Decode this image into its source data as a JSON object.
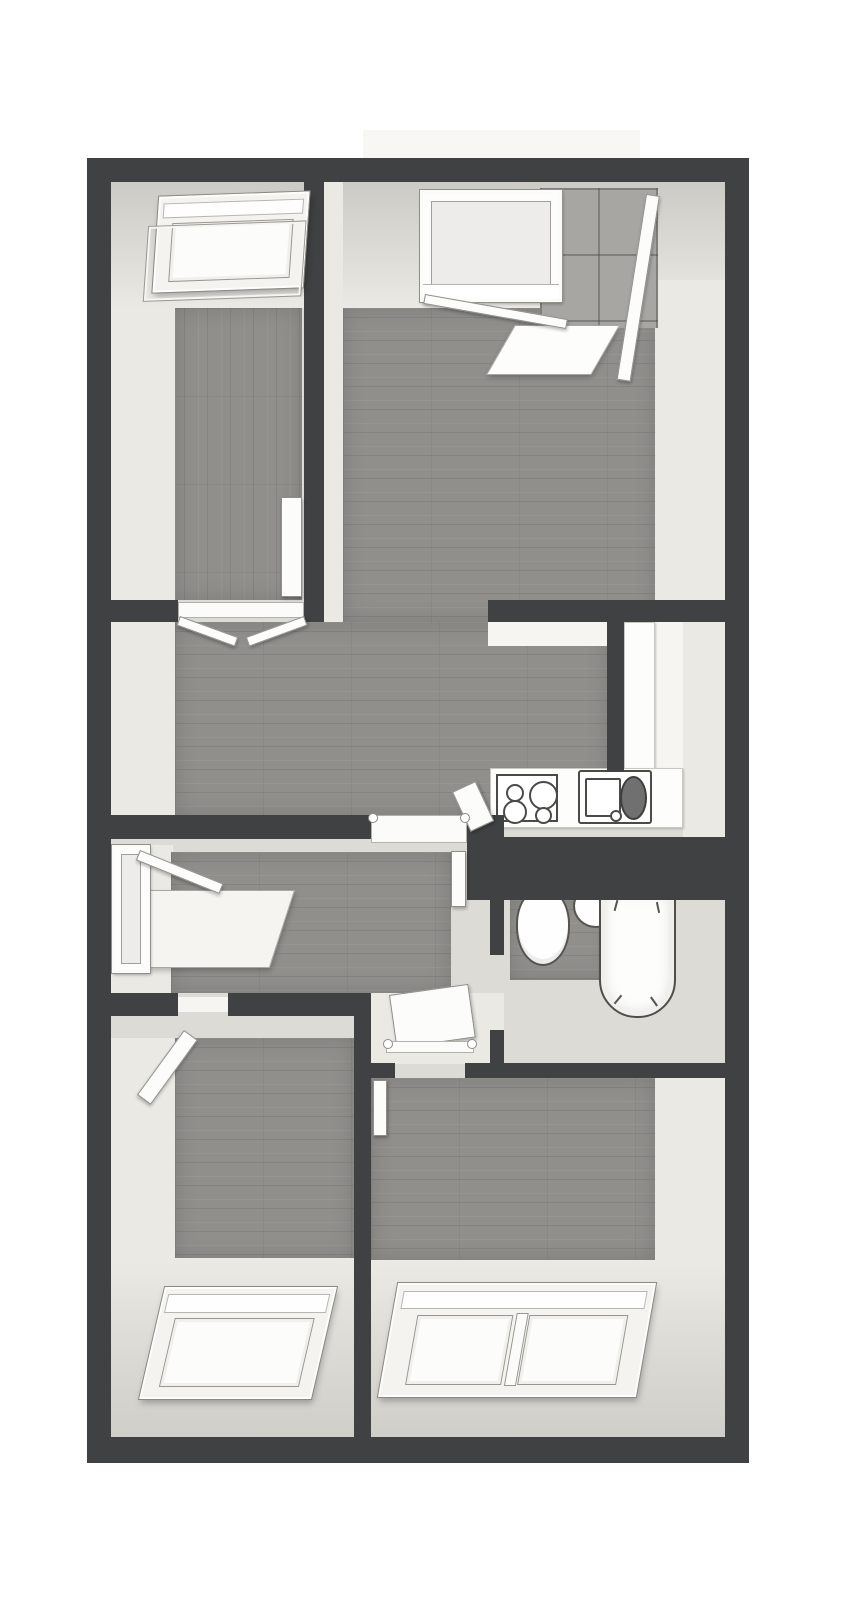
{
  "meta": {
    "kind": "floor-plan-3d-render",
    "canvas": {
      "width": 867,
      "height": 1600
    }
  },
  "palette": {
    "paper": "#ffffff",
    "wall_dark": "#3f4142",
    "face_light": "#eae9e4",
    "face_mid": "#dcdbd6",
    "face_dim": "#cfcec9",
    "wood": "#908f8c",
    "white": "#fdfdfc",
    "off_white": "#f6f5f2",
    "balcony_slab": "#f8f7f4",
    "tile_gray": "#a7a6a3",
    "fixture_outline": "#4a4a48",
    "drainer_dark": "#707070"
  },
  "rooms": [
    {
      "name": "bedroom-top-left",
      "features": [
        "roof-window"
      ]
    },
    {
      "name": "living-room",
      "features": [
        "window",
        "balcony-door",
        "tiled-balcony"
      ]
    },
    {
      "name": "kitchen-nook",
      "features": [
        "l-counter",
        "cooktop-4-burners",
        "sink-with-drainer"
      ]
    },
    {
      "name": "hallway-upper",
      "features": [
        "double-door-to-bedroom"
      ]
    },
    {
      "name": "hallway-lower",
      "features": [
        "side-window",
        "window-bench"
      ]
    },
    {
      "name": "bathroom",
      "features": [
        "toilet",
        "washbasin",
        "bathtub"
      ]
    },
    {
      "name": "bedroom-bottom-left",
      "features": [
        "roof-window",
        "door"
      ]
    },
    {
      "name": "bedroom-bottom-right",
      "features": [
        "double-roof-window",
        "door"
      ]
    }
  ],
  "elements": [
    {
      "name": "balcony-slab",
      "type": "rect",
      "x": 363,
      "y": 130,
      "w": 277,
      "h": 28,
      "z": 0,
      "fill": "balcony_slab"
    },
    {
      "name": "plan-base",
      "type": "rect",
      "x": 87,
      "y": 158,
      "w": 662,
      "h": 1305,
      "z": 0,
      "fill": "face_mid"
    },
    {
      "name": "bedroom-tl-west-wall-face",
      "type": "rect",
      "x": 111,
      "y": 180,
      "w": 64,
      "h": 422,
      "z": 1,
      "fill": "face_light"
    },
    {
      "name": "bedroom-tl-sloped-ceiling",
      "type": "slope",
      "x": 111,
      "y": 180,
      "w": 193,
      "h": 128,
      "z": 1,
      "dir": "top"
    },
    {
      "name": "bedroom-tl-wood-floor",
      "type": "wood",
      "x": 175,
      "y": 308,
      "w": 127,
      "h": 292,
      "z": 1,
      "dir": "v"
    },
    {
      "name": "living-room-sloped-ceiling",
      "type": "slope",
      "x": 343,
      "y": 180,
      "w": 382,
      "h": 128,
      "z": 1,
      "dir": "top"
    },
    {
      "name": "partition-wall-face",
      "type": "rect",
      "x": 324,
      "y": 180,
      "w": 19,
      "h": 442,
      "z": 1,
      "fill": "face_light"
    },
    {
      "name": "living-room-east-wall-face",
      "type": "rect",
      "x": 655,
      "y": 280,
      "w": 70,
      "h": 342,
      "z": 1,
      "fill": "face_light"
    },
    {
      "name": "living-room-wood-floor",
      "type": "wood",
      "x": 343,
      "y": 308,
      "w": 312,
      "h": 314,
      "z": 1,
      "dir": "h"
    },
    {
      "name": "hallway-upper-wood-floor",
      "type": "wood",
      "x": 175,
      "y": 622,
      "w": 432,
      "h": 193,
      "z": 1,
      "dir": "h"
    },
    {
      "name": "hallway-upper-west-face",
      "type": "rect",
      "x": 111,
      "y": 622,
      "w": 64,
      "h": 193,
      "z": 1,
      "fill": "face_light"
    },
    {
      "name": "balcony-tiles",
      "type": "tiles",
      "x": 540,
      "y": 188,
      "w": 118,
      "h": 140,
      "z": 2
    },
    {
      "name": "balcony-threshold",
      "type": "slab",
      "x": 515,
      "y": 325,
      "w": 105,
      "h": 50,
      "z": 3,
      "transform": "skewX(-30deg)",
      "origin": "top left",
      "fill": "white"
    },
    {
      "name": "living-room-window",
      "type": "frame",
      "x": 420,
      "y": 190,
      "w": 142,
      "h": 112,
      "z": 5,
      "inset": 8,
      "paneTiles": true,
      "sill": 14
    },
    {
      "name": "window-open-sash",
      "type": "door",
      "x": 425,
      "y": 294,
      "w": 145,
      "h": 10,
      "z": 5,
      "transform": "rotate(10deg)",
      "origin": "left top"
    },
    {
      "name": "balcony-door-panel",
      "type": "door",
      "x": 646,
      "y": 195,
      "w": 14,
      "h": 188,
      "z": 5,
      "transform": "rotate(9deg)",
      "origin": "top center"
    },
    {
      "name": "kitchen-north-face",
      "type": "rect",
      "x": 488,
      "y": 622,
      "w": 135,
      "h": 24,
      "z": 2,
      "fill": "off_white"
    },
    {
      "name": "kitchen-counter-side",
      "type": "counter",
      "x": 624,
      "y": 622,
      "w": 31,
      "h": 152,
      "z": 2
    },
    {
      "name": "kitchen-floor",
      "type": "rect",
      "x": 655,
      "y": 622,
      "w": 28,
      "h": 152,
      "z": 1,
      "fill": "off_white"
    },
    {
      "name": "kitchen-east-wall-face",
      "type": "rect",
      "x": 683,
      "y": 600,
      "w": 42,
      "h": 245,
      "z": 1,
      "fill": "face_light"
    },
    {
      "name": "kitchen-counter-bottom",
      "type": "counter",
      "x": 490,
      "y": 768,
      "w": 193,
      "h": 60,
      "z": 2
    },
    {
      "name": "cooktop",
      "type": "stove",
      "x": 496,
      "y": 774,
      "w": 62,
      "h": 48,
      "z": 3,
      "burners": [
        {
          "l": 8,
          "t": 8,
          "s": 14
        },
        {
          "l": 5,
          "t": 24,
          "s": 20
        },
        {
          "l": 31,
          "t": 5,
          "s": 25
        },
        {
          "l": 37,
          "t": 31,
          "s": 13
        }
      ]
    },
    {
      "name": "kitchen-sink",
      "type": "sink",
      "x": 578,
      "y": 770,
      "w": 74,
      "h": 54,
      "z": 3
    },
    {
      "name": "kitchen-open-door",
      "type": "door",
      "x": 452,
      "y": 792,
      "w": 26,
      "h": 44,
      "z": 5,
      "transform": "rotate(-25deg)",
      "origin": "top left"
    },
    {
      "name": "hallway-lower-west-face",
      "type": "rect",
      "x": 111,
      "y": 845,
      "w": 62,
      "h": 148,
      "z": 1,
      "fill": "face_light"
    },
    {
      "name": "hallway-lower-wood-floor",
      "type": "wood",
      "x": 171,
      "y": 852,
      "w": 280,
      "h": 141,
      "z": 1,
      "dir": "h"
    },
    {
      "name": "hallway-window",
      "type": "frame",
      "x": 112,
      "y": 845,
      "w": 38,
      "h": 128,
      "z": 5,
      "inset": 6
    },
    {
      "name": "hallway-window-sash",
      "type": "door",
      "x": 140,
      "y": 850,
      "w": 90,
      "h": 11,
      "z": 5,
      "transform": "rotate(22deg)",
      "origin": "left top"
    },
    {
      "name": "window-bench",
      "type": "slab",
      "x": 140,
      "y": 890,
      "w": 155,
      "h": 78,
      "z": 3,
      "transform": "skewX(-18deg)",
      "origin": "top left"
    },
    {
      "name": "hallway-end-door",
      "type": "door",
      "x": 451,
      "y": 851,
      "w": 15,
      "h": 56,
      "z": 5
    },
    {
      "name": "door-nook-floor",
      "type": "rect",
      "x": 371,
      "y": 993,
      "w": 133,
      "h": 71,
      "z": 1,
      "fill": "face_light"
    },
    {
      "name": "nook-open-door",
      "type": "door",
      "x": 389,
      "y": 995,
      "w": 80,
      "h": 54,
      "z": 5,
      "transform": "rotate(-8deg)",
      "origin": "top left"
    },
    {
      "name": "nook-door-threshold",
      "type": "threshold",
      "x": 386,
      "y": 1041,
      "w": 88,
      "h": 12,
      "z": 5,
      "posts": true
    },
    {
      "name": "upper-hall-threshold",
      "type": "threshold",
      "x": 371,
      "y": 815,
      "w": 96,
      "h": 28,
      "z": 5,
      "posts": true
    },
    {
      "name": "bathroom-floor-base",
      "type": "rect",
      "x": 504,
      "y": 900,
      "w": 221,
      "h": 164,
      "z": 1,
      "fill": "face_mid"
    },
    {
      "name": "bathroom-wood-floor",
      "type": "wood",
      "x": 510,
      "y": 900,
      "w": 102,
      "h": 80,
      "z": 1,
      "dir": "h"
    },
    {
      "name": "toilet",
      "type": "toilet",
      "x": 516,
      "y": 888,
      "w": 54,
      "h": 78,
      "z": 3
    },
    {
      "name": "washbasin",
      "type": "oval",
      "x": 573,
      "y": 884,
      "w": 46,
      "h": 44,
      "z": 3
    },
    {
      "name": "bathtub",
      "type": "tub",
      "x": 599,
      "y": 888,
      "w": 77,
      "h": 130,
      "z": 3
    },
    {
      "name": "bedroom-bl-west-face",
      "type": "rect",
      "x": 111,
      "y": 1016,
      "w": 64,
      "h": 421,
      "z": 1,
      "fill": "face_light"
    },
    {
      "name": "bedroom-bl-north-face",
      "type": "rect",
      "x": 111,
      "y": 1016,
      "w": 243,
      "h": 22,
      "z": 1,
      "fill": "face_mid"
    },
    {
      "name": "bedroom-bl-wood-floor",
      "type": "wood",
      "x": 175,
      "y": 1038,
      "w": 179,
      "h": 222,
      "z": 1,
      "dir": "h"
    },
    {
      "name": "bedroom-bl-sloped-ceiling",
      "type": "slope",
      "x": 111,
      "y": 1258,
      "w": 243,
      "h": 179,
      "z": 1,
      "dir": "bottom"
    },
    {
      "name": "bedroom-bl-roof-window",
      "type": "skylight",
      "x": 152,
      "y": 1287,
      "w": 172,
      "h": 112,
      "z": 5,
      "transform": "skewX(-13deg)",
      "panes": 1
    },
    {
      "name": "bedroom-bl-door",
      "type": "door",
      "x": 184,
      "y": 1030,
      "w": 17,
      "h": 80,
      "z": 5,
      "transform": "rotate(36deg)",
      "origin": "top left"
    },
    {
      "name": "bedroom-bl-threshold",
      "type": "rect",
      "x": 178,
      "y": 997,
      "w": 50,
      "h": 15,
      "z": 2,
      "fill": "off_white"
    },
    {
      "name": "bedroom-br-wood-floor",
      "type": "wood",
      "x": 371,
      "y": 1078,
      "w": 284,
      "h": 182,
      "z": 1,
      "dir": "h"
    },
    {
      "name": "bedroom-br-east-face",
      "type": "rect",
      "x": 655,
      "y": 1078,
      "w": 70,
      "h": 359,
      "z": 1,
      "fill": "face_light"
    },
    {
      "name": "bedroom-br-sloped-ceiling",
      "type": "slope",
      "x": 371,
      "y": 1260,
      "w": 354,
      "h": 177,
      "z": 1,
      "dir": "bottom"
    },
    {
      "name": "bedroom-br-roof-window",
      "type": "skylight",
      "x": 388,
      "y": 1283,
      "w": 258,
      "h": 114,
      "z": 5,
      "transform": "skewX(-10deg)",
      "panes": 2
    },
    {
      "name": "bedroom-br-door",
      "type": "door",
      "x": 373,
      "y": 1080,
      "w": 14,
      "h": 56,
      "z": 5
    },
    {
      "name": "bedroom-tl-roof-window",
      "type": "skylight",
      "x": 156,
      "y": 194,
      "w": 150,
      "h": 96,
      "z": 5,
      "transform": "skewX(-6deg) rotate(-2deg)",
      "panes": 1,
      "sash": true
    },
    {
      "name": "bedroom-tl-side-door",
      "type": "door",
      "x": 281,
      "y": 497,
      "w": 21,
      "h": 100,
      "z": 5
    },
    {
      "name": "bedroom-tl-door-threshold",
      "type": "threshold",
      "x": 178,
      "y": 602,
      "w": 126,
      "h": 16,
      "z": 5
    },
    {
      "name": "double-door-panel-left",
      "type": "door",
      "x": 180,
      "y": 616,
      "w": 62,
      "h": 10,
      "z": 5,
      "transform": "rotate(20deg)",
      "origin": "left top"
    },
    {
      "name": "double-door-panel-right",
      "type": "door",
      "x": 242,
      "y": 616,
      "w": 62,
      "h": 10,
      "z": 5,
      "transform": "rotate(-20deg)",
      "origin": "right top"
    },
    {
      "name": "outer-wall-top",
      "type": "wall",
      "x": 87,
      "y": 158,
      "w": 662,
      "h": 24,
      "z": 4
    },
    {
      "name": "outer-wall-left",
      "type": "wall",
      "x": 87,
      "y": 158,
      "w": 24,
      "h": 1305,
      "z": 4
    },
    {
      "name": "outer-wall-right",
      "type": "wall",
      "x": 725,
      "y": 158,
      "w": 24,
      "h": 1305,
      "z": 4
    },
    {
      "name": "outer-wall-bottom",
      "type": "wall",
      "x": 87,
      "y": 1437,
      "w": 662,
      "h": 26,
      "z": 4
    },
    {
      "name": "wall-between-top-rooms",
      "type": "wall",
      "x": 304,
      "y": 180,
      "w": 20,
      "h": 442,
      "z": 4
    },
    {
      "name": "wall-below-bedroom-tl",
      "type": "wall",
      "x": 87,
      "y": 600,
      "w": 91,
      "h": 22,
      "z": 4
    },
    {
      "name": "wall-kitchen-north",
      "type": "wall",
      "x": 488,
      "y": 600,
      "w": 237,
      "h": 22,
      "z": 4
    },
    {
      "name": "wall-kitchen-partition",
      "type": "wall",
      "x": 607,
      "y": 622,
      "w": 17,
      "h": 150,
      "z": 4
    },
    {
      "name": "wall-hallway-south",
      "type": "wall",
      "x": 87,
      "y": 815,
      "w": 284,
      "h": 24,
      "z": 4
    },
    {
      "name": "wall-corner-block",
      "type": "wall",
      "x": 467,
      "y": 815,
      "w": 37,
      "h": 24,
      "z": 4
    },
    {
      "name": "wall-bathroom-north",
      "type": "wall",
      "x": 467,
      "y": 837,
      "w": 258,
      "h": 63,
      "z": 4
    },
    {
      "name": "wall-bathroom-west-a",
      "type": "wall",
      "x": 490,
      "y": 900,
      "w": 14,
      "h": 55,
      "z": 4
    },
    {
      "name": "wall-bathroom-west-b",
      "type": "wall",
      "x": 490,
      "y": 1030,
      "w": 14,
      "h": 34,
      "z": 4
    },
    {
      "name": "wall-bedroom-bl-north-a",
      "type": "wall",
      "x": 87,
      "y": 993,
      "w": 91,
      "h": 23,
      "z": 4
    },
    {
      "name": "wall-bedroom-bl-north-b",
      "type": "wall",
      "x": 228,
      "y": 993,
      "w": 126,
      "h": 23,
      "z": 4
    },
    {
      "name": "wall-between-bottom-rooms",
      "type": "wall",
      "x": 354,
      "y": 993,
      "w": 17,
      "h": 444,
      "z": 4
    },
    {
      "name": "wall-bedroom-br-north-a",
      "type": "wall",
      "x": 371,
      "y": 1063,
      "w": 24,
      "h": 15,
      "z": 4
    },
    {
      "name": "wall-bedroom-br-north-b",
      "type": "wall",
      "x": 465,
      "y": 1063,
      "w": 260,
      "h": 15,
      "z": 4
    }
  ]
}
